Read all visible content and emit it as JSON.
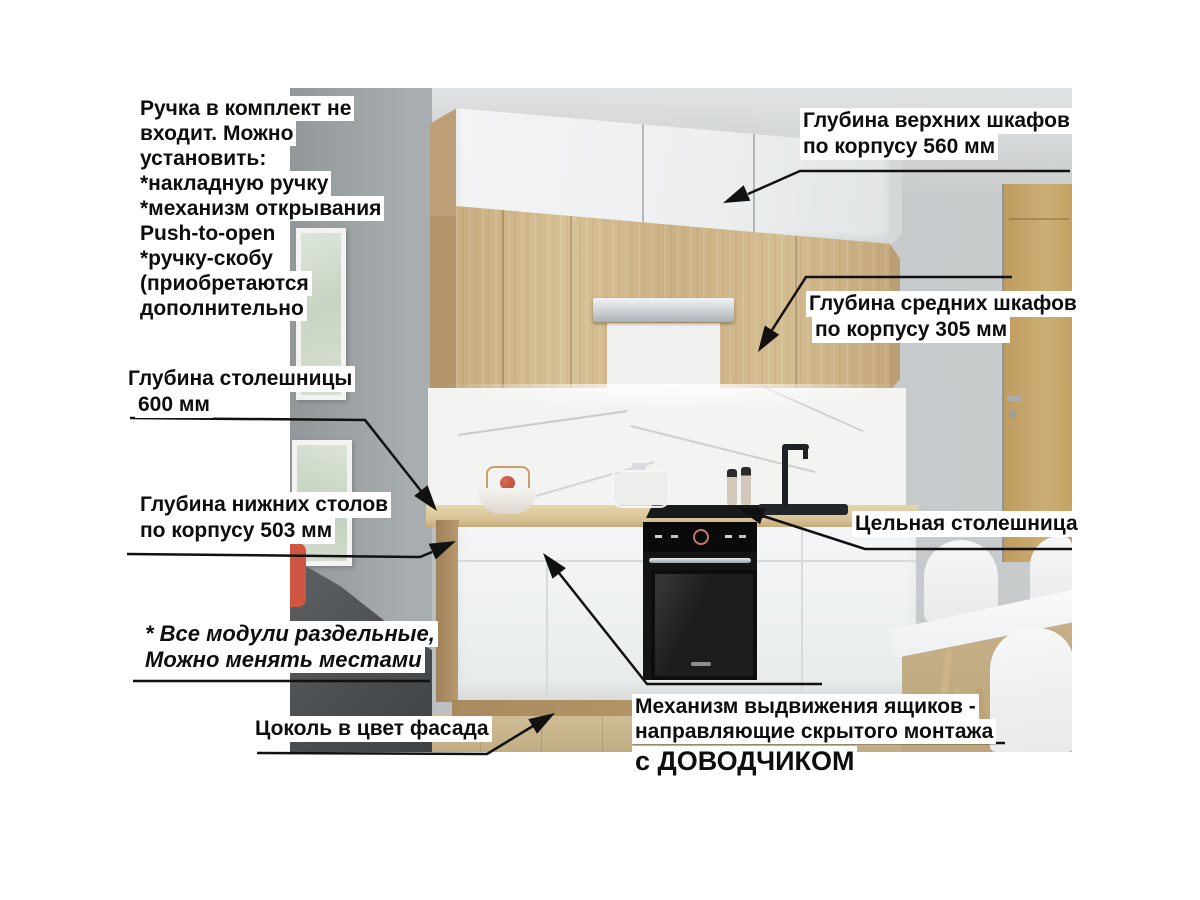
{
  "annotations": {
    "handle_note": {
      "lines": [
        "Ручка в комплект не",
        "входит. Можно",
        "установить:",
        "*накладную ручку",
        "*механизм открывания",
        "Push-to-open",
        "*ручку-скобу",
        "(приобретаются",
        "дополнительно"
      ]
    },
    "upper_depth": {
      "lines": [
        "Глубина верхних шкафов",
        "по корпусу 560 мм"
      ]
    },
    "middle_depth": {
      "lines": [
        "Глубина средних шкафов",
        "по корпусу 305 мм"
      ]
    },
    "countertop_depth": {
      "lines": [
        "Глубина столешницы",
        "600 мм"
      ]
    },
    "base_depth": {
      "lines": [
        "Глубина нижних столов",
        "по корпусу 503 мм"
      ]
    },
    "modules_note": {
      "lines": [
        "* Все модули раздельные,",
        "Можно менять местами"
      ]
    },
    "plinth_note": {
      "text": "Цоколь в цвет фасада"
    },
    "drawer_note": {
      "lines": [
        "Механизм выдвижения ящиков -",
        "направляющие скрытого монтажа"
      ],
      "emphasis": "с ДОВОДЧИКОМ"
    },
    "solid_top": {
      "text": "Цельная столешница"
    }
  },
  "colors": {
    "label_background": "#ffffff",
    "label_text": "#0e0e0e",
    "arrow": "#111111",
    "wood_facade": "#cdb389",
    "white_facade": "#f2f3f4",
    "wall": "#c3c7c9",
    "countertop": "#d9c498",
    "oven": "#141414"
  }
}
